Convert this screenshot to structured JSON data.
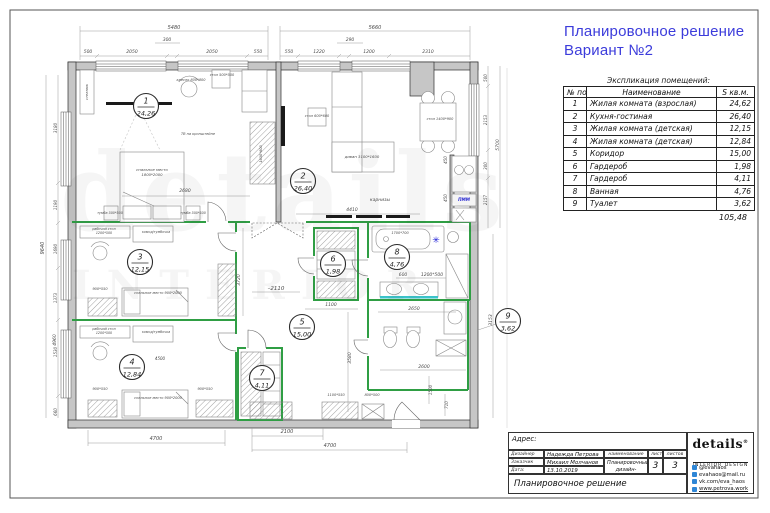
{
  "title": {
    "line1": "Планировочное решение",
    "line2": "Вариант №2",
    "accent_color": "#3c3cdb"
  },
  "watermark": {
    "line1": "details",
    "line2": "INTERIOR"
  },
  "explication": {
    "caption": "Экспликация помещений:",
    "columns": [
      "№ пом",
      "Наименование",
      "S кв.м."
    ],
    "rows": [
      [
        "1",
        "Жилая комната (взрослая)",
        "24,62"
      ],
      [
        "2",
        "Кухня-гостиная",
        "26,40"
      ],
      [
        "3",
        "Жилая комната (детская)",
        "12,15"
      ],
      [
        "4",
        "Жилая комната (детская)",
        "12,84"
      ],
      [
        "5",
        "Коридор",
        "15,00"
      ],
      [
        "6",
        "Гардероб",
        "1,98"
      ],
      [
        "7",
        "Гардероб",
        "4,11"
      ],
      [
        "8",
        "Ванная",
        "4,76"
      ],
      [
        "9",
        "Туалет",
        "3,62"
      ]
    ],
    "total": "105,48"
  },
  "plan": {
    "partition_color": "#2f9e44",
    "note_color": "#1b1bd6",
    "rooms": [
      {
        "num": "1",
        "area": "24,26",
        "x": 146,
        "y": 106
      },
      {
        "num": "2",
        "area": "26,40",
        "x": 303,
        "y": 181
      },
      {
        "num": "3",
        "area": "12,15",
        "x": 140,
        "y": 262
      },
      {
        "num": "4",
        "area": "12,84",
        "x": 132,
        "y": 367
      },
      {
        "num": "5",
        "area": "15,00",
        "x": 302,
        "y": 327
      },
      {
        "num": "6",
        "area": "1,98",
        "x": 333,
        "y": 264
      },
      {
        "num": "7",
        "area": "4,11",
        "x": 262,
        "y": 378
      },
      {
        "num": "8",
        "area": "4,76",
        "x": 397,
        "y": 257
      },
      {
        "num": "9",
        "area": "3,62",
        "x": 508,
        "y": 321
      }
    ],
    "labels": [
      {
        "t": "5480",
        "x": 174,
        "y": 29,
        "s": 5
      },
      {
        "t": "5660",
        "x": 375,
        "y": 29,
        "s": 5
      },
      {
        "t": "300",
        "x": 167,
        "y": 41,
        "s": 4.5
      },
      {
        "t": "290",
        "x": 350,
        "y": 41,
        "s": 4.5
      },
      {
        "t": "500",
        "x": 88,
        "y": 53,
        "s": 4.5
      },
      {
        "t": "2050",
        "x": 132,
        "y": 53,
        "s": 4.5
      },
      {
        "t": "2050",
        "x": 212,
        "y": 53,
        "s": 4.5
      },
      {
        "t": "550",
        "x": 258,
        "y": 53,
        "s": 4.5
      },
      {
        "t": "550",
        "x": 289,
        "y": 53,
        "s": 4.5
      },
      {
        "t": "1220",
        "x": 319,
        "y": 53,
        "s": 4.5
      },
      {
        "t": "1200",
        "x": 369,
        "y": 53,
        "s": 4.5
      },
      {
        "t": "2310",
        "x": 428,
        "y": 53,
        "s": 4.5
      },
      {
        "t": "4700",
        "x": 156,
        "y": 440,
        "s": 5
      },
      {
        "t": "2100",
        "x": 287,
        "y": 433,
        "s": 5
      },
      {
        "t": "4700",
        "x": 330,
        "y": 447,
        "s": 5
      },
      {
        "t": "9640",
        "x": 44,
        "y": 248,
        "s": 5,
        "r": -90
      },
      {
        "t": "4960",
        "x": 56,
        "y": 340,
        "s": 4.5,
        "r": -90
      },
      {
        "t": "3180",
        "x": 57,
        "y": 128,
        "s": 4,
        "r": -90
      },
      {
        "t": "1190",
        "x": 57,
        "y": 205,
        "s": 4,
        "r": -90
      },
      {
        "t": "1690",
        "x": 57,
        "y": 249,
        "s": 4,
        "r": -90
      },
      {
        "t": "1373",
        "x": 57,
        "y": 298,
        "s": 4,
        "r": -90
      },
      {
        "t": "1530",
        "x": 57,
        "y": 352,
        "s": 4,
        "r": -90
      },
      {
        "t": "660",
        "x": 57,
        "y": 412,
        "s": 4,
        "r": -90
      },
      {
        "t": "500",
        "x": 487,
        "y": 78,
        "s": 4,
        "r": -90
      },
      {
        "t": "2153",
        "x": 487,
        "y": 120,
        "s": 4,
        "r": -90
      },
      {
        "t": "300",
        "x": 487,
        "y": 166,
        "s": 4,
        "r": -90
      },
      {
        "t": "2157",
        "x": 487,
        "y": 200,
        "s": 4,
        "r": -90
      },
      {
        "t": "5700",
        "x": 499,
        "y": 145,
        "s": 4.5,
        "r": -90
      },
      {
        "t": "3153",
        "x": 492,
        "y": 320,
        "s": 4.5,
        "r": -90
      },
      {
        "t": "2680",
        "x": 185,
        "y": 192,
        "s": 4.5
      },
      {
        "t": "4410",
        "x": 352,
        "y": 211,
        "s": 4.5
      },
      {
        "t": "карнизы",
        "x": 380,
        "y": 201,
        "s": 4.5
      },
      {
        "t": "3720",
        "x": 240,
        "y": 280,
        "s": 4.5,
        "r": -90
      },
      {
        "t": "–2110",
        "x": 276,
        "y": 290,
        "s": 5.5
      },
      {
        "t": "1100",
        "x": 331,
        "y": 306,
        "s": 4.5
      },
      {
        "t": "3580",
        "x": 351,
        "y": 358,
        "s": 4.5,
        "r": -90
      },
      {
        "t": "2650",
        "x": 414,
        "y": 310,
        "s": 4.5
      },
      {
        "t": "2600",
        "x": 424,
        "y": 368,
        "s": 4.5
      },
      {
        "t": "1500",
        "x": 432,
        "y": 390,
        "s": 4,
        "r": -90
      },
      {
        "t": "710",
        "x": 448,
        "y": 405,
        "s": 4,
        "r": -90
      },
      {
        "t": "600",
        "x": 403,
        "y": 276,
        "s": 4.5
      },
      {
        "t": "1200*500",
        "x": 432,
        "y": 276,
        "s": 4.5
      },
      {
        "t": "450",
        "x": 447,
        "y": 160,
        "s": 4,
        "r": -90
      },
      {
        "t": "450",
        "x": 447,
        "y": 198,
        "s": 4,
        "r": -90
      },
      {
        "t": "стеллаж",
        "x": 88,
        "y": 92,
        "s": 3.5,
        "r": -90,
        "n": "furniture-label"
      },
      {
        "t": "кресло 800*800",
        "x": 191,
        "y": 81,
        "s": 3.5,
        "n": "furniture-label"
      },
      {
        "t": "стол 500*500",
        "x": 222,
        "y": 76,
        "s": 3.5,
        "n": "furniture-label"
      },
      {
        "t": "1630*600",
        "x": 262,
        "y": 154,
        "s": 3.5,
        "r": -90,
        "n": "furniture-label"
      },
      {
        "t": "ТВ на кронштейне",
        "x": 198,
        "y": 135,
        "s": 3.5,
        "n": "furniture-label"
      },
      {
        "t": "спальное место",
        "x": 152,
        "y": 171,
        "s": 3.8,
        "n": "furniture-label"
      },
      {
        "t": "1800*2000",
        "x": 152,
        "y": 176,
        "s": 3.8,
        "n": "furniture-label"
      },
      {
        "t": "тумба 500*500",
        "x": 110,
        "y": 214,
        "s": 3.3,
        "n": "furniture-label"
      },
      {
        "t": "тумба 500*500",
        "x": 193,
        "y": 214,
        "s": 3.3,
        "n": "furniture-label"
      },
      {
        "t": "стол 600*600",
        "x": 317,
        "y": 117,
        "s": 3.5,
        "n": "furniture-label"
      },
      {
        "t": "диван 3100*1600",
        "x": 362,
        "y": 158,
        "s": 3.8,
        "n": "furniture-label"
      },
      {
        "t": "стол 1400*900",
        "x": 440,
        "y": 120,
        "s": 3.5,
        "n": "furniture-label"
      },
      {
        "t": "рабочий стол",
        "x": 104,
        "y": 230,
        "s": 3.3,
        "n": "furniture-label"
      },
      {
        "t": "1200*500",
        "x": 104,
        "y": 234,
        "s": 3.3,
        "n": "furniture-label"
      },
      {
        "t": "комод/тумбочка",
        "x": 156,
        "y": 233,
        "s": 3.3,
        "n": "furniture-label"
      },
      {
        "t": "спальное место 900*2000",
        "x": 158,
        "y": 294,
        "s": 3.5,
        "n": "furniture-label"
      },
      {
        "t": "900*550",
        "x": 100,
        "y": 290,
        "s": 3.5,
        "n": "furniture-label"
      },
      {
        "t": "рабочий стол",
        "x": 104,
        "y": 330,
        "s": 3.3,
        "n": "furniture-label"
      },
      {
        "t": "1200*500",
        "x": 104,
        "y": 334,
        "s": 3.3,
        "n": "furniture-label"
      },
      {
        "t": "комод/тумбочка",
        "x": 156,
        "y": 333,
        "s": 3.3,
        "n": "furniture-label"
      },
      {
        "t": "4500",
        "x": 160,
        "y": 360,
        "s": 4
      },
      {
        "t": "спальное место 900*2000",
        "x": 158,
        "y": 399,
        "s": 3.5,
        "n": "furniture-label"
      },
      {
        "t": "900*550",
        "x": 100,
        "y": 390,
        "s": 3.5,
        "n": "furniture-label"
      },
      {
        "t": "900*550",
        "x": 205,
        "y": 390,
        "s": 3.5,
        "n": "furniture-label"
      },
      {
        "t": "1100*550",
        "x": 336,
        "y": 396,
        "s": 3.5,
        "n": "furniture-label"
      },
      {
        "t": "800*500",
        "x": 372,
        "y": 396,
        "s": 3.5,
        "n": "furniture-label"
      },
      {
        "t": "1700*700",
        "x": 400,
        "y": 234,
        "s": 3.5,
        "n": "furniture-label"
      },
      {
        "t": "ПММ",
        "x": 464,
        "y": 201,
        "s": 4.2,
        "c": "#1b1bd6",
        "b": true,
        "n": "dishwasher-label"
      },
      {
        "t": "✳",
        "x": 436,
        "y": 243,
        "s": 9,
        "c": "#1b1bd6",
        "n": "note-asterisk"
      }
    ]
  },
  "titleblock": {
    "address_label": "Адрес:",
    "designer_label": "Дизайнер",
    "designer_value": "Надежда Петрова",
    "client_label": "Заказчик",
    "client_value": "Михаил Молчанов",
    "date_label": "Дата:",
    "date_value": "13.10.2019",
    "name_header": "наименование",
    "project_name": "Планировочный дизайн-проект",
    "sheet_header": "лист",
    "sheets_header": "листов",
    "sheet_number": "3",
    "sheets_total": "3",
    "doc_title": "Планировочное решение",
    "logo": {
      "brand": "details",
      "registered": "®",
      "subtitle": "INTERIOR DESIGN"
    },
    "socials": [
      {
        "icon": "instagram-icon",
        "text": "@evahaos"
      },
      {
        "icon": "email-icon",
        "text": "evahaos@mail.ru"
      },
      {
        "icon": "vk-icon",
        "text": "vk.com/eva_haos"
      },
      {
        "icon": "website-icon",
        "text": "www.petrova.work"
      }
    ]
  }
}
